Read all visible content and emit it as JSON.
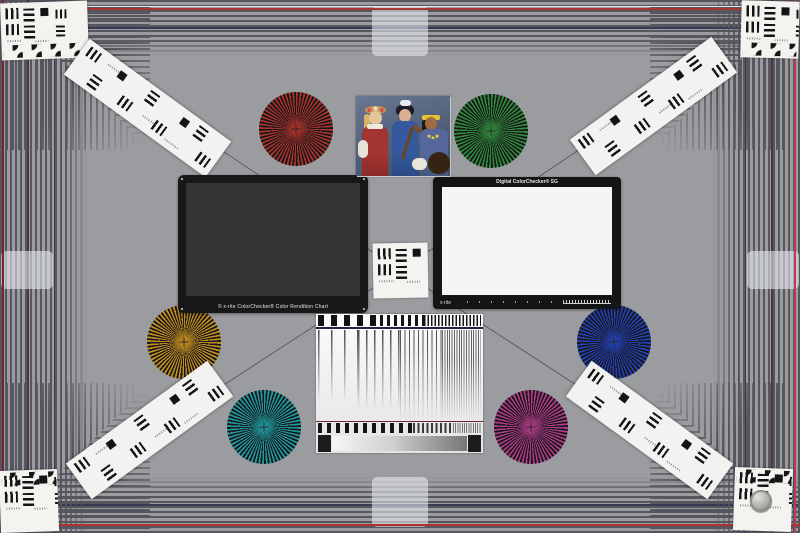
{
  "scene": {
    "description_visible_text_only": true
  },
  "palette": {
    "background": "#9b9c9f",
    "stripe_dark": "#55565e",
    "stripe_navy": "#353b55",
    "frame_red_top": "#a83434",
    "frame_maroon_left": "#7a2330",
    "frame_crimson_right": "#bb3b50",
    "frame_red_bottom": "#b03030"
  },
  "starbursts": [
    {
      "name": "red",
      "color": "#a9322a"
    },
    {
      "name": "green",
      "color": "#2f8a3a"
    },
    {
      "name": "gold",
      "color": "#c28c1e"
    },
    {
      "name": "blue",
      "color": "#2340b4"
    },
    {
      "name": "teal",
      "color": "#1f989c"
    },
    {
      "name": "magenta",
      "color": "#af3a86"
    }
  ],
  "charts": {
    "colorchecker_classic": {
      "label": "© x-rite ColorChecker® Color Rendition Chart",
      "rows": 4,
      "cols": 6,
      "patches": [
        [
          "#735244",
          "#c29682",
          "#627a9d",
          "#576c43",
          "#8580b1",
          "#67bdaa"
        ],
        [
          "#d67e2c",
          "#505ba6",
          "#c15a63",
          "#5e3c6c",
          "#9dbc40",
          "#e0a32e"
        ],
        [
          "#383d96",
          "#469449",
          "#af363c",
          "#e7c71f",
          "#bb5695",
          "#0885a1"
        ],
        [
          "#f3f3f2",
          "#c8c8c8",
          "#a0a0a0",
          "#7a7a7a",
          "#555555",
          "#343434"
        ]
      ]
    },
    "colorchecker_sg": {
      "title": "Digital ColorChecker® SG",
      "logo": "x-rite",
      "rows": 10,
      "cols": 14,
      "patches": [
        [
          "#f5f5f5",
          "#999999",
          "#1a1a1a",
          "#f5f5f5",
          "#999999",
          "#1a1a1a",
          "#f5f5f5",
          "#999999",
          "#1a1a1a",
          "#f5f5f5",
          "#999999",
          "#1a1a1a",
          "#999999",
          "#f5f5f5"
        ],
        [
          "#1a1a1a",
          "#c82a5a",
          "#5a2d82",
          "#9fd8d0",
          "#2a2a2a",
          "#e0a060",
          "#88b8e8",
          "#8a1a32",
          "#6a5acd",
          "#1e8a8a",
          "#f0b0c8",
          "#f08030",
          "#d02a4a",
          "#999999"
        ],
        [
          "#999999",
          "#e8b8d8",
          "#c03a8a",
          "#f0c8a8",
          "#f08828",
          "#1a3a8a",
          "#70c8e0",
          "#a8d858",
          "#58b848",
          "#d03030",
          "#f8a8b8",
          "#c82838",
          "#801828",
          "#1a1a1a"
        ],
        [
          "#f5f5f5",
          "#7a3a9a",
          "#3a5ac8",
          "#a8d8a8",
          "#1a2a6a",
          "#101a4a",
          "#6a7a9a",
          "#2a8a4a",
          "#28b8b8",
          "#b8d048",
          "#e8e8e8",
          "#f098b8",
          "#d83048",
          "#f5f5f5"
        ],
        [
          "#1a1a1a",
          "#a8e0e0",
          "#f0c0d0",
          "#f8f8f8",
          "#1a1a1a",
          "#787878",
          "#2a2a2a",
          "#111111",
          "#1a4a2a",
          "#888888",
          "#4a8a5a",
          "#f8f8f8",
          "#e8c0d8",
          "#999999"
        ],
        [
          "#999999",
          "#98c0e8",
          "#58c8c0",
          "#f0f0d0",
          "#1a1a1a",
          "#909090",
          "#686868",
          "#505050",
          "#383838",
          "#151515",
          "#787878",
          "#282828",
          "#f09030",
          "#e8c818"
        ],
        [
          "#f5f5f5",
          "#288a8a",
          "#1a6a7a",
          "#e89878",
          "#f0a888",
          "#f8c8a8",
          "#d8a878",
          "#a86838",
          "#e88868",
          "#f0b088",
          "#883838",
          "#e8d028",
          "#f0e050",
          "#f5f5f5"
        ],
        [
          "#1a1a1a",
          "#8098a8",
          "#286878",
          "#b84838",
          "#e89068",
          "#f8b890",
          "#c89868",
          "#e8a878",
          "#905030",
          "#c88858",
          "#a8a8a8",
          "#b8c838",
          "#48a838",
          "#999999"
        ],
        [
          "#999999",
          "#a8d8a8",
          "#48a848",
          "#28a878",
          "#88c888",
          "#b8d868",
          "#98d838",
          "#28882a",
          "#1a8a6a",
          "#48c8a8",
          "#909090",
          "#787878",
          "#2a6a2a",
          "#1a1a1a"
        ],
        [
          "#f5f5f5",
          "#999999",
          "#1a1a1a",
          "#f5f5f5",
          "#999999",
          "#1a1a1a",
          "#f5f5f5",
          "#999999",
          "#1a1a1a",
          "#f5f5f5",
          "#999999",
          "#1a1a1a",
          "#999999",
          "#f5f5f5"
        ]
      ]
    }
  }
}
